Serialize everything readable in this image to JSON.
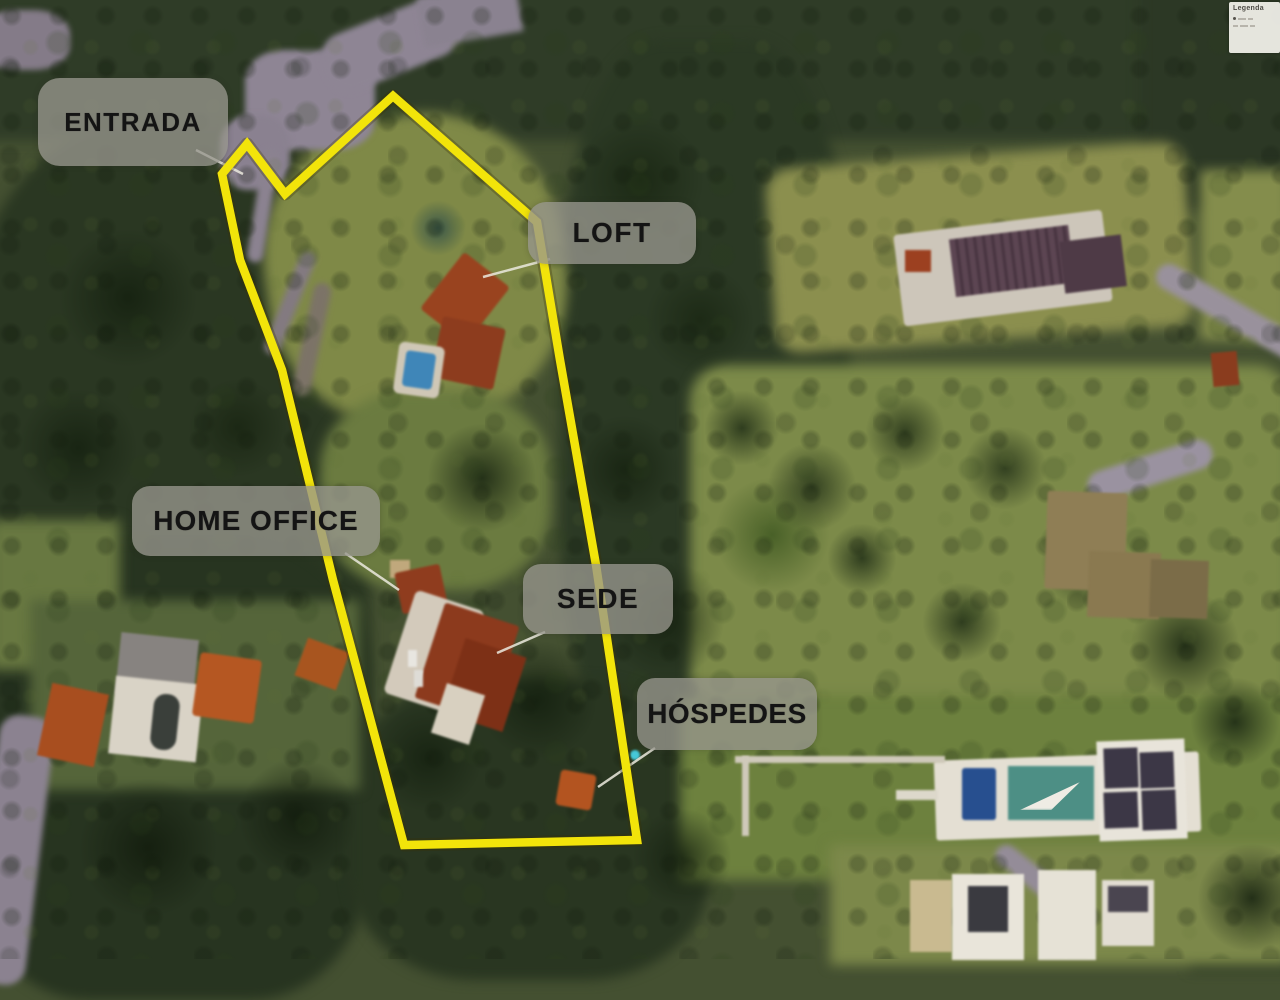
{
  "image": {
    "kind": "aerial-photo-site-plan",
    "width": 1280,
    "height": 959
  },
  "legend": {
    "title": "Legenda"
  },
  "labels": [
    {
      "id": "entrada",
      "text": "ENTRADA",
      "box": [
        38,
        78,
        190,
        88
      ],
      "pointer": [
        196,
        150,
        243,
        174
      ]
    },
    {
      "id": "loft",
      "text": "LOFT",
      "box": [
        528,
        202,
        168,
        62
      ],
      "pointer": [
        550,
        259,
        483,
        277
      ]
    },
    {
      "id": "home-office",
      "text": "HOME OFFICE",
      "box": [
        132,
        486,
        248,
        70
      ],
      "pointer": [
        345,
        553,
        399,
        590
      ]
    },
    {
      "id": "sede",
      "text": "SEDE",
      "box": [
        523,
        564,
        150,
        70
      ],
      "pointer": [
        545,
        632,
        497,
        653
      ]
    },
    {
      "id": "hospedes",
      "text": "HÓSPEDES",
      "box": [
        637,
        678,
        180,
        72
      ],
      "pointer": [
        655,
        748,
        598,
        787
      ]
    }
  ],
  "boundary": {
    "color": "#f2e40a",
    "stroke_width": 8.5,
    "points": [
      [
        393,
        96
      ],
      [
        537,
        222
      ],
      [
        560,
        360
      ],
      [
        596,
        565
      ],
      [
        637,
        840
      ],
      [
        404,
        845
      ],
      [
        333,
        580
      ],
      [
        282,
        370
      ],
      [
        240,
        260
      ],
      [
        222,
        174
      ],
      [
        247,
        144
      ],
      [
        285,
        194
      ]
    ]
  },
  "colors": {
    "pointer_line": "#eceadf",
    "label_background": "rgba(151,150,141,0.78)",
    "label_text": "#141414"
  }
}
